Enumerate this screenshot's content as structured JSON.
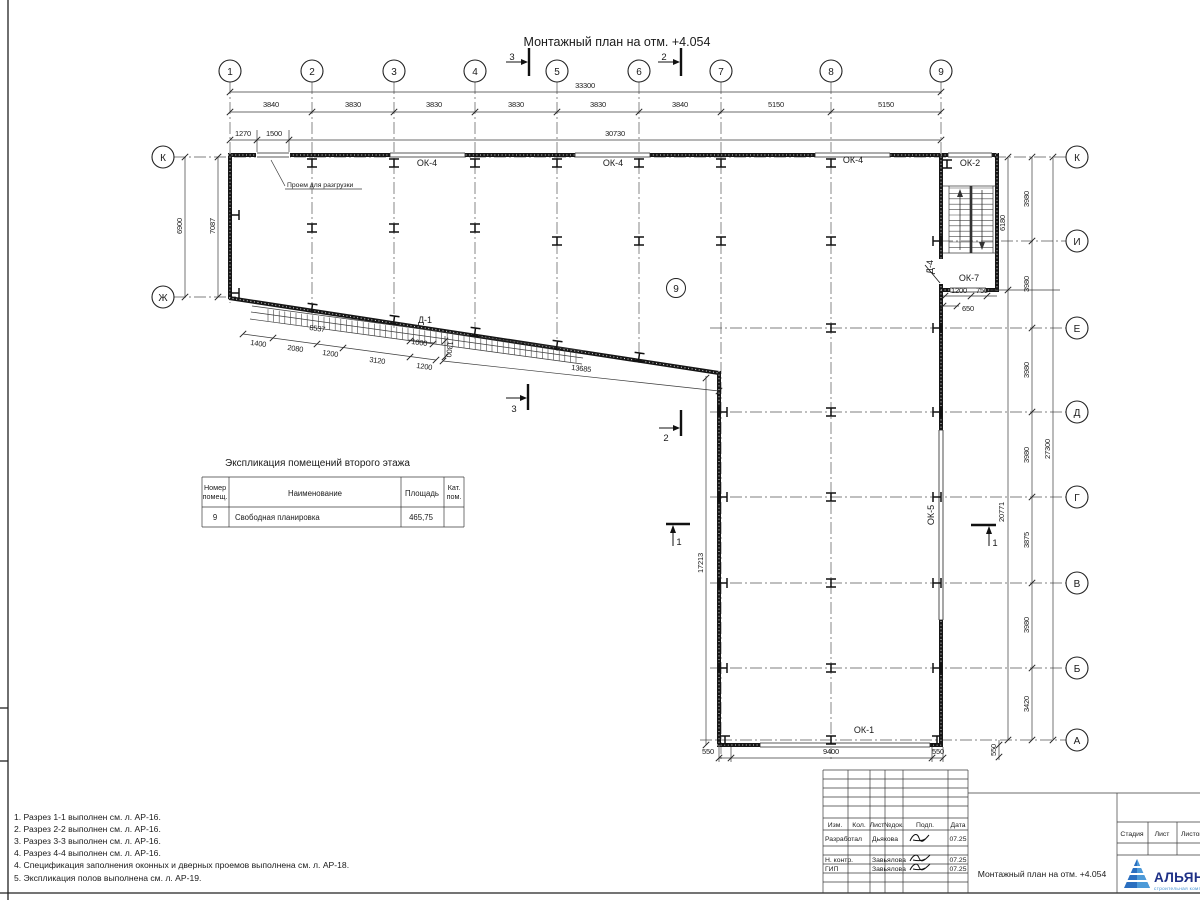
{
  "sheet": {
    "title": "Монтажный план на отм. +4.054"
  },
  "axes": {
    "top": [
      "1",
      "2",
      "3",
      "4",
      "5",
      "6",
      "7",
      "8",
      "9"
    ],
    "right": [
      "К",
      "И",
      "Е",
      "Д",
      "Г",
      "В",
      "Б",
      "А"
    ],
    "left": [
      "К",
      "Ж"
    ]
  },
  "dims": {
    "top_overall": "33300",
    "top_segments": [
      "3840",
      "3830",
      "3830",
      "3830",
      "3830",
      "3840",
      "5150",
      "5150"
    ],
    "sub": [
      "1270",
      "1500",
      "30730"
    ],
    "left": [
      "6900",
      "7087"
    ],
    "right": {
      "stair_h": "6180",
      "leg_h": "20771",
      "overall": "27300",
      "segments": [
        "3980",
        "3980",
        "3980",
        "3980",
        "3875",
        "3980",
        "3420"
      ]
    },
    "stair": [
      "1200",
      "750",
      "650"
    ],
    "bottom": [
      "550",
      "9400",
      "550",
      "550"
    ],
    "leg_inner": "17213",
    "diagonal": "13685",
    "ramp": {
      "length": "8537",
      "segments": [
        "1400",
        "2080",
        "1200",
        "3120",
        "1200"
      ],
      "extra": [
        "1000",
        "1300"
      ]
    }
  },
  "marks": {
    "ok4": "ОК-4",
    "ok2": "ОК-2",
    "ok7": "ОК-7",
    "ok5": "ОК-5",
    "ok1": "ОК-1",
    "d1": "Д-1",
    "d4": "Д-4",
    "room": "9",
    "opening": "Проем для разгрузки",
    "s1": "1",
    "s2": "2",
    "s3": "3"
  },
  "table": {
    "title": "Экспликация помещений второго этажа",
    "headers": {
      "num": [
        "Номер",
        "помещ."
      ],
      "name": "Наименование",
      "area": "Площадь",
      "cat": [
        "Кат.",
        "пом."
      ]
    },
    "rows": [
      {
        "num": "9",
        "name": "Свободная планировка",
        "area": "465,75",
        "cat": ""
      }
    ]
  },
  "notes": [
    "1. Разрез 1-1 выполнен см. л. АР-16.",
    "2. Разрез 2-2 выполнен см. л. АР-16.",
    "3. Разрез 3-3 выполнен см. л. АР-16.",
    "4. Разрез 4-4 выполнен см. л. АР-16.",
    "4. Спецификация заполнения оконных и дверных проемов выполнена см. л. АР-18.",
    "5. Экспликация полов выполнена см. л. АР-19."
  ],
  "titleblock": {
    "header": [
      "Изм.",
      "Кол.",
      "Лист",
      "№док.",
      "Подп.",
      "Дата"
    ],
    "rows": [
      {
        "role": "Разработал",
        "name": "Дьякова",
        "date": "07.25"
      },
      {
        "role": "Н. контр.",
        "name": "Завьялова",
        "date": "07.25"
      },
      {
        "role": "ГИП",
        "name": "Завьялова",
        "date": "07.25"
      }
    ],
    "doc_title": "Монтажный план на отм. +4.054",
    "stage": [
      "Стадия",
      "Лист",
      "Листов"
    ],
    "logo": {
      "name": "АЛЬЯНС",
      "tagline": "строительная компания"
    }
  },
  "colors": {
    "line": "#1a1a1a",
    "logo_navy": "#1d2f86",
    "logo_blue": "#3f8fd2"
  }
}
